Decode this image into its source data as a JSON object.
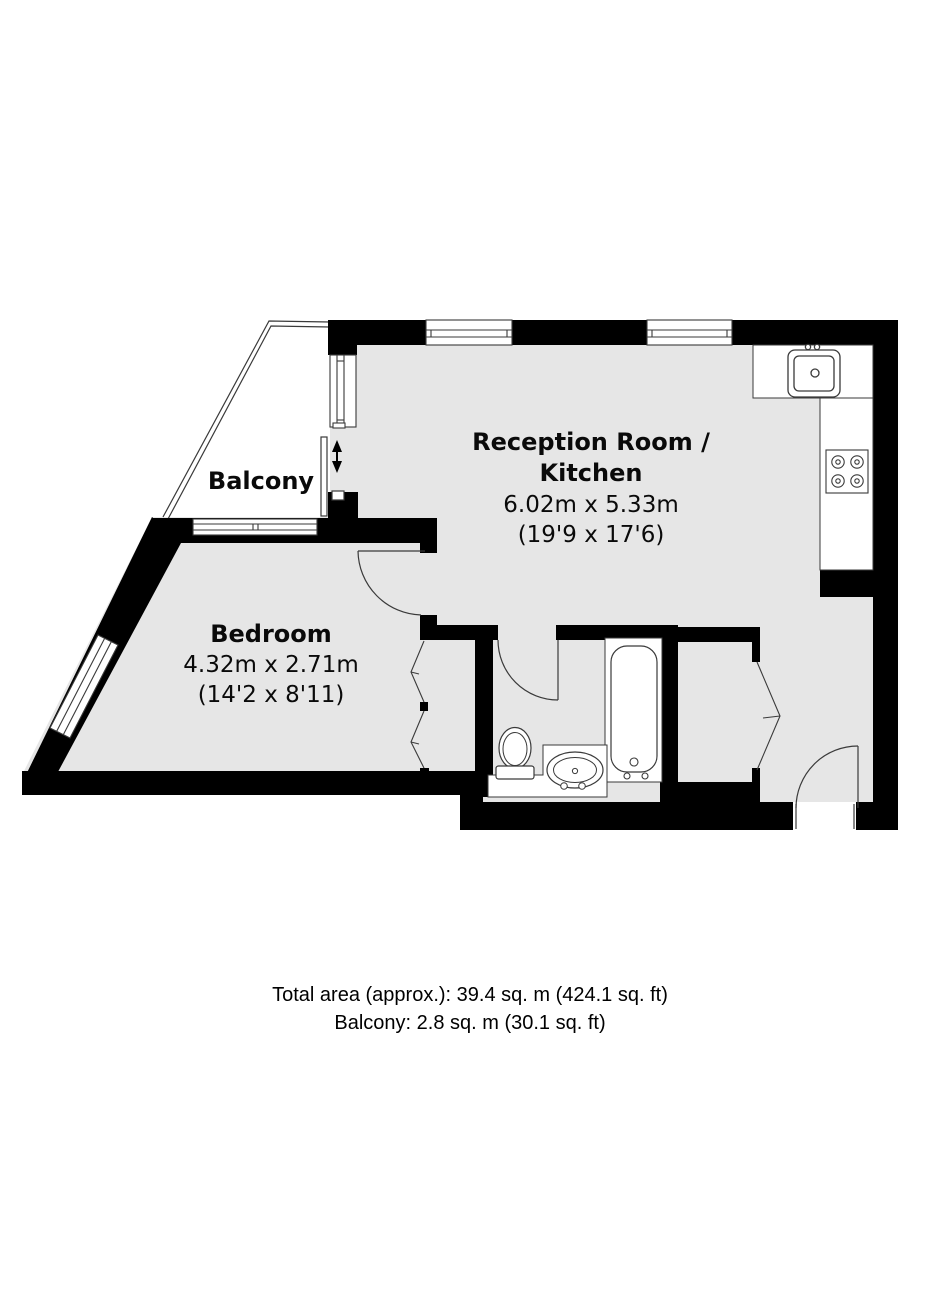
{
  "plan": {
    "type": "floor-plan",
    "colors": {
      "wall": "#000000",
      "floor": "#e6e6e6",
      "line": "#3a3a3a",
      "background": "#ffffff"
    },
    "rooms": {
      "reception": {
        "name_line1": "Reception Room /",
        "name_line2": "Kitchen",
        "dimensions_metric": "6.02m x 5.33m",
        "dimensions_imperial": "(19'9 x 17'6)"
      },
      "bedroom": {
        "name": "Bedroom",
        "dimensions_metric": "4.32m x 2.71m",
        "dimensions_imperial": "(14'2 x 8'11)"
      },
      "balcony": {
        "name": "Balcony"
      }
    },
    "fixtures": [
      "kitchen-sink",
      "hob",
      "kitchen-counter",
      "bathtub",
      "toilet",
      "wash-basin",
      "bedroom-wardrobe-bifold",
      "hallway-closet-bifold",
      "bedroom-door",
      "bathroom-door",
      "entrance-door",
      "sliding-balcony-door",
      "windows",
      "balcony-railing"
    ],
    "summary": {
      "total_area": "Total area (approx.): 39.4 sq. m (424.1 sq. ft)",
      "balcony_area": "Balcony: 2.8 sq. m (30.1 sq. ft)"
    }
  }
}
